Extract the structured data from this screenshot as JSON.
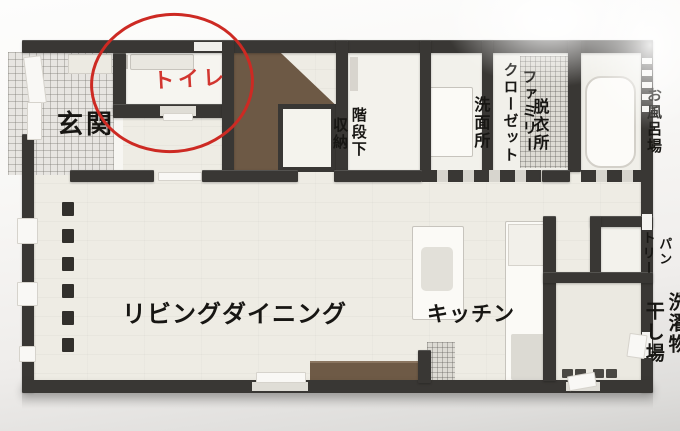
{
  "rooms": {
    "entrance": {
      "label": "玄関"
    },
    "toilet": {
      "label": "トイレ",
      "label_color": "#d23630"
    },
    "stair_storage": {
      "lines": [
        "階段下",
        "収納"
      ]
    },
    "family_closet": {
      "lines": [
        "ファミリー",
        "クローゼット"
      ]
    },
    "washroom": {
      "label": "洗面所"
    },
    "dressing_room": {
      "label": "脱衣所"
    },
    "bathroom": {
      "label": "お風呂場"
    },
    "pantry": {
      "lines": [
        "パン",
        "トリー"
      ]
    },
    "living_dining": {
      "label": "リビングダイニング"
    },
    "kitchen": {
      "label": "キッチン"
    },
    "laundry": {
      "lines": [
        "洗濯物",
        "干し場"
      ]
    }
  },
  "annotation": {
    "shape": "hand-drawn ellipse",
    "target": "トイレ",
    "color": "#cd2a23"
  },
  "colors": {
    "wall": "#393734",
    "floor": "#eeece4",
    "stairs_brown": "#6d5945",
    "tv_board_brown": "#6e5a46",
    "entrance_tile": "#e7e5e1",
    "accent_red": "#cd2a23",
    "background": "#f8f7f5"
  }
}
